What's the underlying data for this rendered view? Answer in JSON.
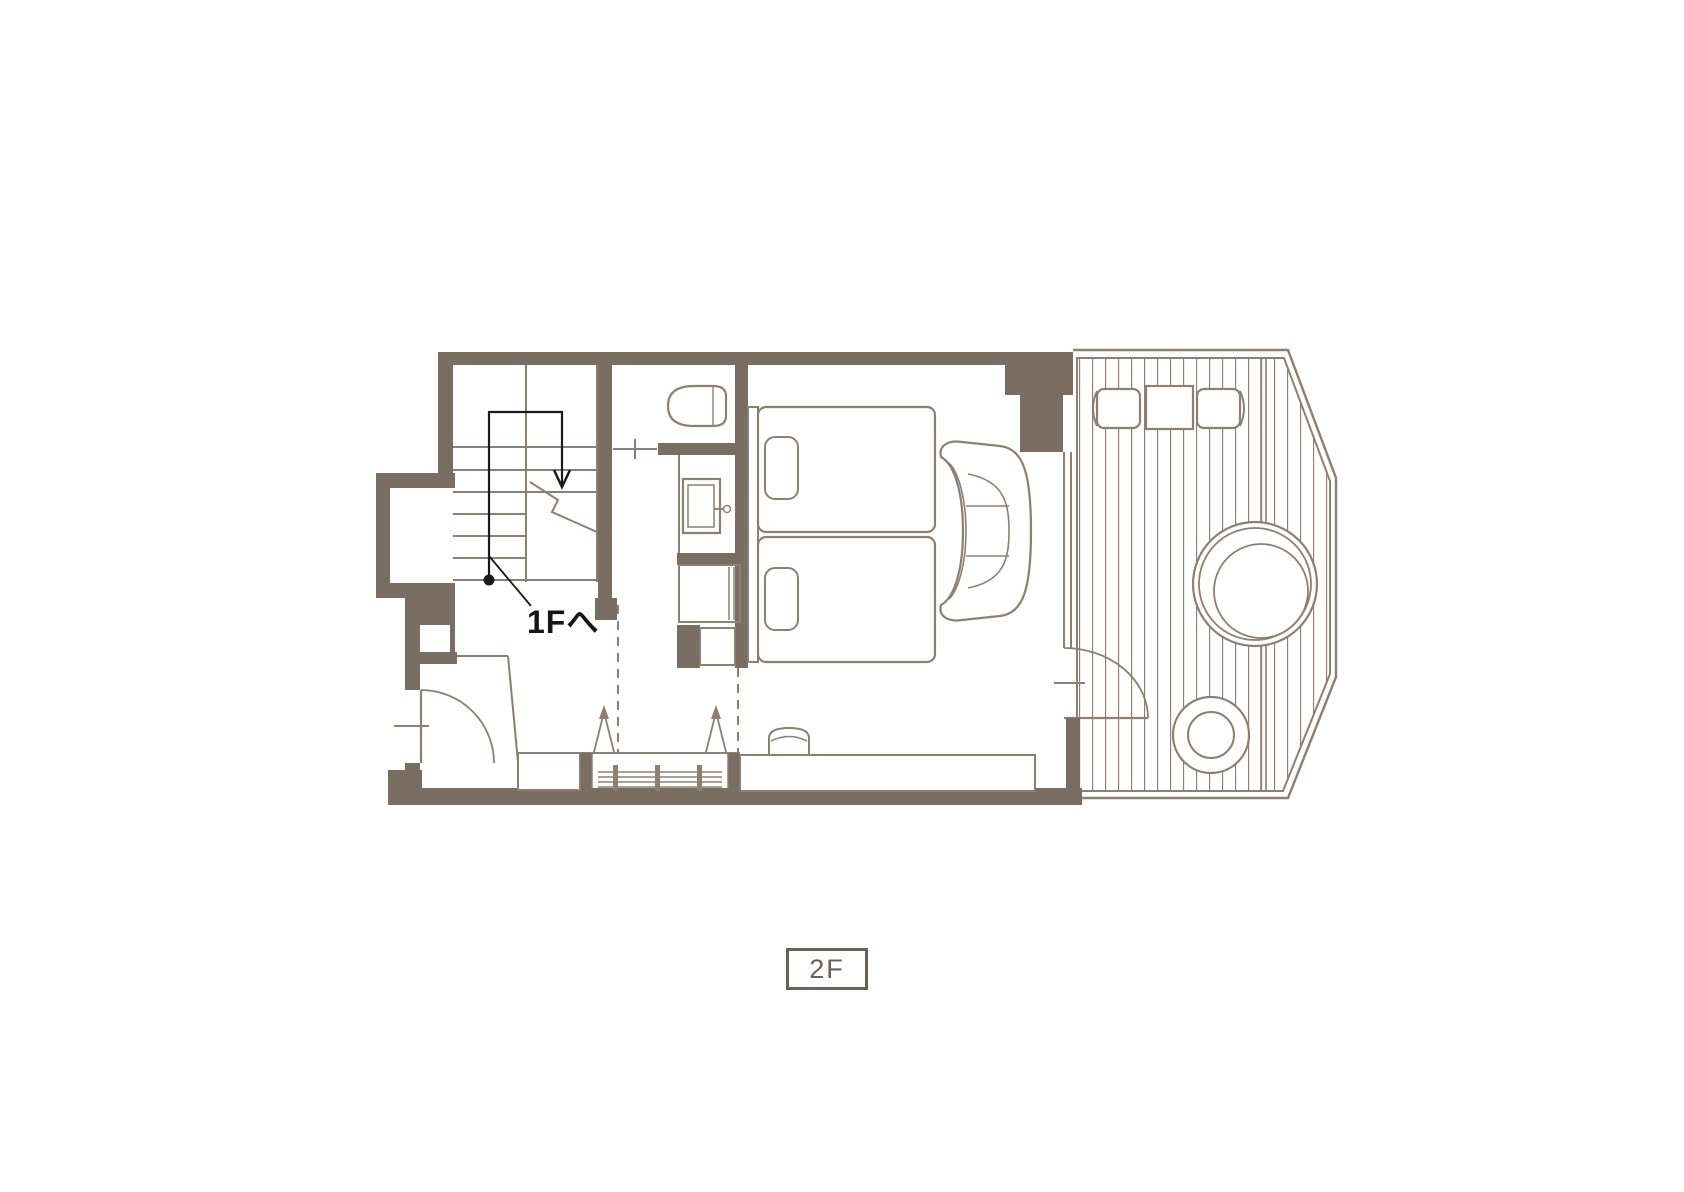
{
  "page": {
    "width": 1684,
    "height": 1192,
    "background": "#ffffff"
  },
  "colors": {
    "wall_fill": "#7a6e63",
    "drawing_line": "#8d7f72",
    "route_black": "#1a1a1a",
    "badge_brown": "#6c6157"
  },
  "labels": {
    "stairs_note": "1Fへ",
    "floor_badge": "2F"
  },
  "fixtures": [
    "staircase",
    "stairs-down-route-arrow",
    "toilet",
    "washbasin",
    "twin-bed",
    "twin-bed",
    "pillow",
    "pillow",
    "sofa",
    "wardrobe-hangers",
    "shoe-cabinet",
    "entrance-door",
    "counter",
    "counter-item",
    "wood-deck",
    "deck-chair",
    "deck-table",
    "deck-chair",
    "round-bathtub",
    "bath-stool",
    "deck-door",
    "window"
  ]
}
